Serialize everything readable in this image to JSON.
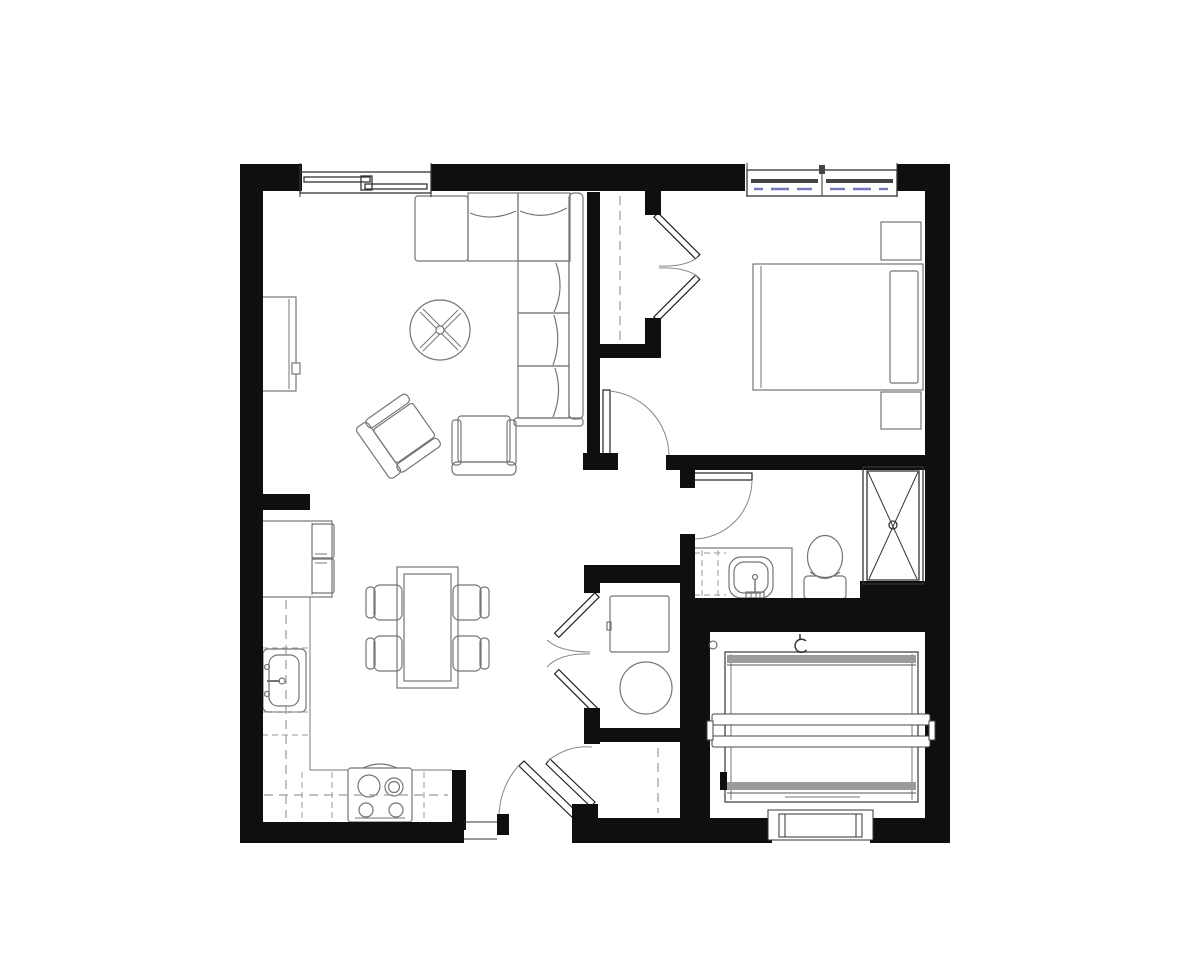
{
  "document": {
    "type": "floor-plan",
    "title": "One-bedroom apartment floor plan, top-down architectural drawing, black linework on white"
  },
  "palette": {
    "background": "#ffffff",
    "wall": "#0f0f0f",
    "thin_line": "#333333",
    "door_line": "#222222",
    "swing_line": "#888888",
    "furniture_line": "#757575",
    "dash_line": "#9a9a9a",
    "window_accent": "#7377c0",
    "deck_band": "#9b9b9b"
  },
  "rooms": [
    {
      "name": "Living Room",
      "furniture": [
        "sectional sofa (L-shaped)",
        "round coffee table with X base",
        "angled accent chair",
        "armchair",
        "media console on west wall"
      ],
      "features": [
        "sliding window on north wall"
      ]
    },
    {
      "name": "Bedroom",
      "furniture": [
        "queen bed with headboard on east wall",
        "nightstand north",
        "nightstand south"
      ],
      "features": [
        "double window on north wall",
        "reach-in closet with double doors",
        "swing entry door at southwest"
      ]
    },
    {
      "name": "Bedroom Closet",
      "features": [
        "hanging rod (dashed)",
        "double doors opening east"
      ]
    },
    {
      "name": "Kitchen",
      "furniture": [
        "refrigerator",
        "L-shaped base counter",
        "single-basin sink",
        "4-burner range"
      ],
      "features": [
        "upper cabinets shown dashed"
      ]
    },
    {
      "name": "Dining Area",
      "furniture": [
        "rectangular dining table",
        "4 dining chairs"
      ]
    },
    {
      "name": "Bathroom",
      "furniture": [
        "vanity with sink",
        "toilet",
        "walk-in shower marked with X"
      ],
      "features": [
        "swing door from hall"
      ]
    },
    {
      "name": "Laundry Closet",
      "furniture": [
        "washer (square)",
        "dryer (round)"
      ],
      "features": [
        "double doors opening west"
      ]
    },
    {
      "name": "Entry",
      "features": [
        "entry swing door in south wall",
        "coat closet with hanging rod and swing door"
      ]
    },
    {
      "name": "Patio / Storage Room",
      "furniture": [
        "deck structure with double cross rails and T-shaped rail ends"
      ],
      "features": [
        "exterior step at south wall",
        "post circle marker",
        "hose-bib glyph"
      ]
    }
  ],
  "icons": [
    "window-glyph",
    "door-swing-arc",
    "bifold-door-chevron",
    "shower-x",
    "sink-basin",
    "toilet",
    "range-burners",
    "washer-square",
    "dryer-circle",
    "closet-rod-dashed",
    "deck-rails",
    "step-threshold",
    "post-circle",
    "hose-bib-glyph"
  ]
}
